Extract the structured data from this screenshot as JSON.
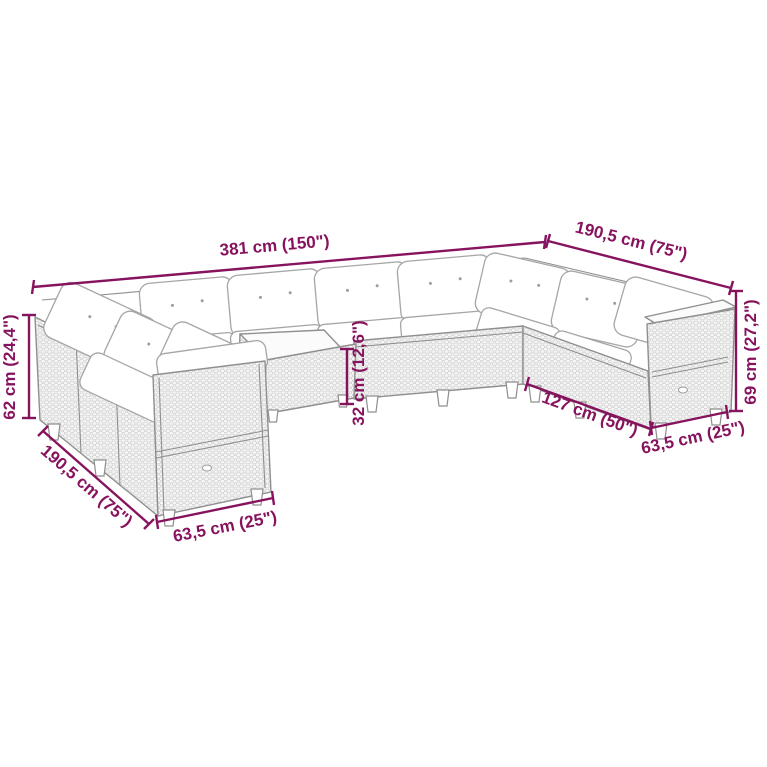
{
  "page": {
    "kind": "furniture dimension line-drawing",
    "background": "#ffffff"
  },
  "colors": {
    "dimension_accent": "#87135E",
    "sketch_outline": "#8f8f8f"
  },
  "dimensions": [
    {
      "id": "back-total-width",
      "label": "381 cm (150\")"
    },
    {
      "id": "right-wing-depth",
      "label": "190,5 cm (75\")"
    },
    {
      "id": "right-arm-height",
      "label": "69 cm (27,2\")"
    },
    {
      "id": "right-section-width",
      "label": "63,5 cm (25\")"
    },
    {
      "id": "inner-front-width",
      "label": "127 cm (50\")"
    },
    {
      "id": "table-height",
      "label": "32 cm (12,6\")"
    },
    {
      "id": "left-back-height",
      "label": "62 cm (24,4\")"
    },
    {
      "id": "left-wing-depth",
      "label": "190,5 cm (75\")"
    },
    {
      "id": "front-section-width",
      "label": "63,5 cm (25\")"
    }
  ]
}
